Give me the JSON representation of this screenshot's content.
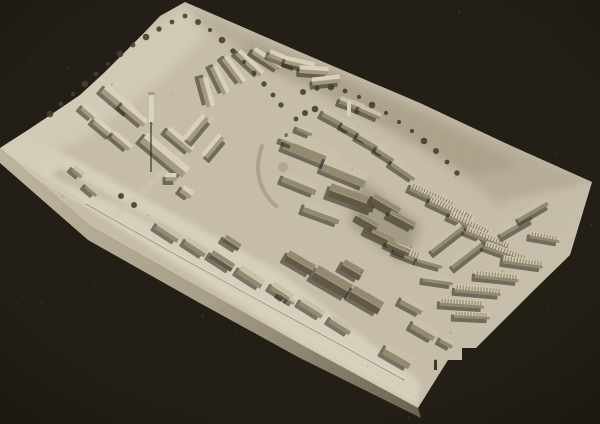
{
  "photo": {
    "description": "Monochrome sepia photograph of a plaster architectural scale model of a hillside town on a rectangular baseboard, viewed obliquely from above against a black background",
    "background_color": "#28231a",
    "background_corner_dark": "#1d1912",
    "model_top_color": "#c6bda9",
    "side_face_gradient": [
      "#bdb49e",
      "#a89f89",
      "#6d6450"
    ],
    "vignette_color": "rgba(0,0,0,0.28)"
  },
  "base": {
    "outline": [
      [
        185,
        2
      ],
      [
        160,
        16
      ],
      [
        143,
        34
      ],
      [
        125,
        52
      ],
      [
        105,
        72
      ],
      [
        80,
        95
      ],
      [
        55,
        112
      ],
      [
        25,
        132
      ],
      [
        0,
        148
      ],
      [
        90,
        226
      ],
      [
        200,
        288
      ],
      [
        300,
        344
      ],
      [
        418,
        408
      ],
      [
        448,
        360
      ],
      [
        462,
        360
      ],
      [
        462,
        348
      ],
      [
        476,
        348
      ],
      [
        532,
        292
      ],
      [
        570,
        255
      ],
      [
        592,
        182
      ],
      [
        505,
        143
      ],
      [
        420,
        103
      ],
      [
        300,
        52
      ]
    ],
    "side_face": [
      [
        0,
        148
      ],
      [
        90,
        226
      ],
      [
        200,
        288
      ],
      [
        300,
        344
      ],
      [
        418,
        408
      ],
      [
        421,
        418
      ],
      [
        298,
        357
      ],
      [
        198,
        302
      ],
      [
        88,
        240
      ],
      [
        0,
        163
      ]
    ]
  },
  "terrain_patches": [
    {
      "points": [
        [
          0,
          118
        ],
        [
          130,
          190
        ],
        [
          280,
          272
        ],
        [
          420,
          382
        ],
        [
          418,
          408
        ],
        [
          300,
          344
        ],
        [
          160,
          254
        ],
        [
          0,
          150
        ]
      ],
      "fill": "#d7d0bd",
      "opacity": 0.95,
      "blur": "b3"
    },
    {
      "points": [
        [
          0,
          140
        ],
        [
          50,
          100
        ],
        [
          110,
          55
        ],
        [
          185,
          5
        ],
        [
          215,
          25
        ],
        [
          160,
          80
        ],
        [
          90,
          135
        ],
        [
          30,
          165
        ]
      ],
      "fill": "#d2cbb8",
      "opacity": 0.9,
      "blur": "b5"
    },
    {
      "points": [
        [
          190,
          8
        ],
        [
          330,
          68
        ],
        [
          470,
          128
        ],
        [
          592,
          181
        ],
        [
          545,
          240
        ],
        [
          430,
          150
        ],
        [
          300,
          80
        ],
        [
          200,
          25
        ]
      ],
      "fill": "#b4ab95",
      "opacity": 0.9,
      "blur": "b5"
    },
    {
      "points": [
        [
          250,
          40
        ],
        [
          400,
          105
        ],
        [
          520,
          165
        ],
        [
          470,
          175
        ],
        [
          330,
          95
        ],
        [
          235,
          55
        ]
      ],
      "fill": "#a89e87",
      "opacity": 0.7,
      "blur": "b5"
    },
    {
      "points": [
        [
          505,
          200
        ],
        [
          592,
          182
        ],
        [
          570,
          255
        ],
        [
          520,
          305
        ],
        [
          480,
          340
        ],
        [
          470,
          300
        ]
      ],
      "fill": "#c6beaa",
      "opacity": 0.9,
      "blur": "b4"
    },
    {
      "points": [
        [
          355,
          175
        ],
        [
          420,
          225
        ],
        [
          405,
          265
        ],
        [
          350,
          225
        ]
      ],
      "fill": "#89806b",
      "opacity": 0.55,
      "blur": "b5"
    },
    {
      "points": [
        [
          60,
          168
        ],
        [
          185,
          238
        ],
        [
          240,
          272
        ],
        [
          120,
          206
        ],
        [
          52,
          176
        ]
      ],
      "fill": "#b1a791",
      "opacity": 0.6,
      "blur": "b3"
    }
  ],
  "roads": [
    {
      "d": "M8,160 C140,240 300,330 416,400",
      "stroke": "#e3dcc9",
      "width": 1.2,
      "opacity": 0.45
    },
    {
      "d": "M85,202 L170,250 L255,297 L338,342 L405,378",
      "stroke": "#ded6c2",
      "width": 1.6,
      "opacity": 0.8
    },
    {
      "d": "M86,204 L171,252 L256,299 L339,344 L404,380",
      "stroke": "#5f5644",
      "width": 0.8,
      "opacity": 0.5
    },
    {
      "d": "M118,214 C150,185 185,155 212,118",
      "stroke": "#cfc7b2",
      "width": 6,
      "opacity": 0.55
    },
    {
      "d": "M262,146 C254,168 258,190 276,206",
      "stroke": "#a89e86",
      "width": 4,
      "opacity": 0.85
    },
    {
      "d": "M496,22 C480,60 488,105 508,138",
      "stroke": "#d8cdaa",
      "width": 2,
      "opacity": 0.06
    }
  ],
  "building_tones": {
    "0": {
      "lit": "#d8d0bb",
      "dark": "#a49a82"
    },
    "1": {
      "lit": "#c9c0aa",
      "dark": "#938a72"
    },
    "2": {
      "lit": "#948a72",
      "dark": "#625945"
    },
    "3": {
      "lit": "#cdc4ab",
      "dark": "#8a8069",
      "stripe": "#645c4a"
    }
  },
  "shadow_color": "rgba(28,24,16,0.5)",
  "buildings": [
    [
      118,
      100,
      36,
      11,
      40,
      0
    ],
    [
      134,
      114,
      30,
      9,
      40,
      0
    ],
    [
      104,
      128,
      24,
      8,
      40,
      0
    ],
    [
      122,
      141,
      22,
      8,
      40,
      0
    ],
    [
      89,
      112,
      16,
      8,
      40,
      0
    ],
    [
      165,
      155,
      55,
      13,
      40,
      0
    ],
    [
      180,
      140,
      32,
      9,
      40,
      0
    ],
    [
      196,
      128,
      30,
      9,
      -50,
      0
    ],
    [
      213,
      146,
      26,
      8,
      -50,
      0
    ],
    [
      171,
      177,
      11,
      8,
      0,
      0
    ],
    [
      187,
      192,
      12,
      9,
      35,
      0
    ],
    [
      92,
      190,
      14,
      7,
      40,
      1
    ],
    [
      78,
      172,
      12,
      7,
      40,
      1
    ],
    [
      207,
      92,
      30,
      9,
      75,
      0
    ],
    [
      220,
      80,
      30,
      8,
      64,
      0
    ],
    [
      234,
      70,
      31,
      8,
      53,
      0
    ],
    [
      250,
      63,
      32,
      8,
      43,
      0
    ],
    [
      267,
      59,
      32,
      8,
      33,
      0
    ],
    [
      284,
      59,
      31,
      8,
      23,
      0
    ],
    [
      300,
      63,
      30,
      8,
      13,
      0
    ],
    [
      314,
      70,
      29,
      8,
      4,
      0
    ],
    [
      326,
      80,
      28,
      8,
      -6,
      0
    ],
    [
      338,
      120,
      33,
      9,
      28,
      1
    ],
    [
      356,
      131,
      30,
      8,
      28,
      1
    ],
    [
      373,
      143,
      33,
      9,
      30,
      1
    ],
    [
      390,
      156,
      30,
      8,
      32,
      1
    ],
    [
      404,
      170,
      28,
      8,
      34,
      1
    ],
    [
      352,
      104,
      25,
      8,
      20,
      1
    ],
    [
      370,
      112,
      23,
      7,
      24,
      1
    ],
    [
      312,
      150,
      56,
      20,
      22,
      1
    ],
    [
      345,
      172,
      46,
      16,
      22,
      1
    ],
    [
      300,
      183,
      36,
      12,
      22,
      1
    ],
    [
      352,
      198,
      48,
      14,
      20,
      2
    ],
    [
      322,
      213,
      38,
      11,
      20,
      1
    ],
    [
      305,
      130,
      16,
      7,
      22,
      1
    ],
    [
      288,
      141,
      14,
      6,
      22,
      1
    ],
    [
      386,
      205,
      30,
      9,
      30,
      2
    ],
    [
      402,
      220,
      28,
      8,
      28,
      2
    ],
    [
      380,
      236,
      30,
      8,
      26,
      2
    ],
    [
      368,
      222,
      22,
      7,
      30,
      2
    ],
    [
      408,
      253,
      26,
      11,
      22,
      3
    ],
    [
      398,
      248,
      24,
      7,
      24,
      2
    ],
    [
      432,
      196,
      46,
      9,
      25,
      3
    ],
    [
      452,
      210,
      48,
      9,
      25,
      3
    ],
    [
      470,
      224,
      44,
      8,
      25,
      3
    ],
    [
      488,
      238,
      46,
      8,
      22,
      3
    ],
    [
      506,
      252,
      44,
      8,
      20,
      3
    ],
    [
      446,
      238,
      40,
      8,
      -38,
      1
    ],
    [
      466,
      254,
      38,
      8,
      -38,
      1
    ],
    [
      515,
      225,
      36,
      8,
      -30,
      1
    ],
    [
      532,
      210,
      34,
      8,
      -30,
      1
    ],
    [
      545,
      237,
      30,
      7,
      10,
      3
    ],
    [
      523,
      262,
      40,
      8,
      8,
      3
    ],
    [
      497,
      276,
      44,
      8,
      6,
      3
    ],
    [
      478,
      290,
      46,
      8,
      5,
      3
    ],
    [
      462,
      303,
      44,
      8,
      4,
      3
    ],
    [
      472,
      315,
      36,
      7,
      3,
      3
    ],
    [
      438,
      280,
      30,
      7,
      8,
      1
    ],
    [
      430,
      262,
      26,
      7,
      15,
      1
    ],
    [
      168,
      232,
      26,
      9,
      33,
      1
    ],
    [
      196,
      247,
      24,
      9,
      33,
      1
    ],
    [
      222,
      261,
      26,
      9,
      33,
      2
    ],
    [
      251,
      277,
      28,
      10,
      33,
      1
    ],
    [
      282,
      292,
      24,
      9,
      33,
      1
    ],
    [
      312,
      308,
      26,
      9,
      32,
      1
    ],
    [
      341,
      325,
      24,
      9,
      32,
      1
    ],
    [
      232,
      243,
      18,
      8,
      33,
      2
    ],
    [
      332,
      282,
      40,
      16,
      30,
      2
    ],
    [
      366,
      300,
      34,
      14,
      30,
      2
    ],
    [
      300,
      263,
      30,
      12,
      30,
      2
    ],
    [
      352,
      270,
      22,
      12,
      30,
      2
    ],
    [
      398,
      356,
      30,
      13,
      30,
      1
    ],
    [
      424,
      330,
      26,
      11,
      30,
      1
    ],
    [
      412,
      305,
      24,
      10,
      28,
      1
    ],
    [
      447,
      342,
      14,
      8,
      28,
      1
    ],
    [
      283,
      296,
      8,
      5,
      33,
      2
    ],
    [
      292,
      301,
      7,
      5,
      33,
      1
    ]
  ],
  "trees": {
    "fill": "#453f2f",
    "radius": 3,
    "positions": [
      [
        50,
        114
      ],
      [
        61,
        104
      ],
      [
        73,
        94
      ],
      [
        85,
        84
      ],
      [
        96,
        74
      ],
      [
        108,
        64
      ],
      [
        120,
        54
      ],
      [
        133,
        45
      ],
      [
        146,
        37
      ],
      [
        159,
        29
      ],
      [
        172,
        22
      ],
      [
        185,
        16
      ],
      [
        198,
        22
      ],
      [
        210,
        30
      ],
      [
        222,
        40
      ],
      [
        233,
        51
      ],
      [
        244,
        62
      ],
      [
        254,
        73
      ],
      [
        264,
        84
      ],
      [
        273,
        95
      ],
      [
        281,
        105
      ],
      [
        303,
        92
      ],
      [
        317,
        88
      ],
      [
        331,
        87
      ],
      [
        345,
        91
      ],
      [
        359,
        97
      ],
      [
        372,
        105
      ],
      [
        386,
        113
      ],
      [
        399,
        122
      ],
      [
        412,
        131
      ],
      [
        424,
        141
      ],
      [
        436,
        151
      ],
      [
        447,
        162
      ],
      [
        457,
        173
      ],
      [
        296,
        119
      ],
      [
        305,
        113
      ],
      [
        315,
        109
      ],
      [
        121,
        196
      ],
      [
        134,
        205
      ]
    ]
  },
  "landmarks": {
    "main_tower": {
      "x": 149,
      "y": 92,
      "w": 5,
      "h": 30,
      "fill": "#d9d2bd",
      "shadow_d": "M151,122 L151,172",
      "shadow_stroke": "rgba(40,34,22,0.7)"
    },
    "citadel_spire": {
      "x": 347,
      "y": 101,
      "w": 4,
      "h": 15,
      "fill": "#d4cdb8"
    },
    "round_bastion": {
      "cx": 283,
      "cy": 167,
      "r": 9,
      "fill": "#c4bca6",
      "inner_r": 5,
      "inner_fill": "#b1a78f"
    },
    "scale_figure": {
      "x": 434,
      "y": 362,
      "w": 3,
      "h": 8,
      "head_r": 1.5,
      "fill": "#3e3828"
    }
  },
  "grain": {
    "seed": 7,
    "count": 220,
    "light": "#d8cdaa",
    "dark": "#3a3426"
  }
}
